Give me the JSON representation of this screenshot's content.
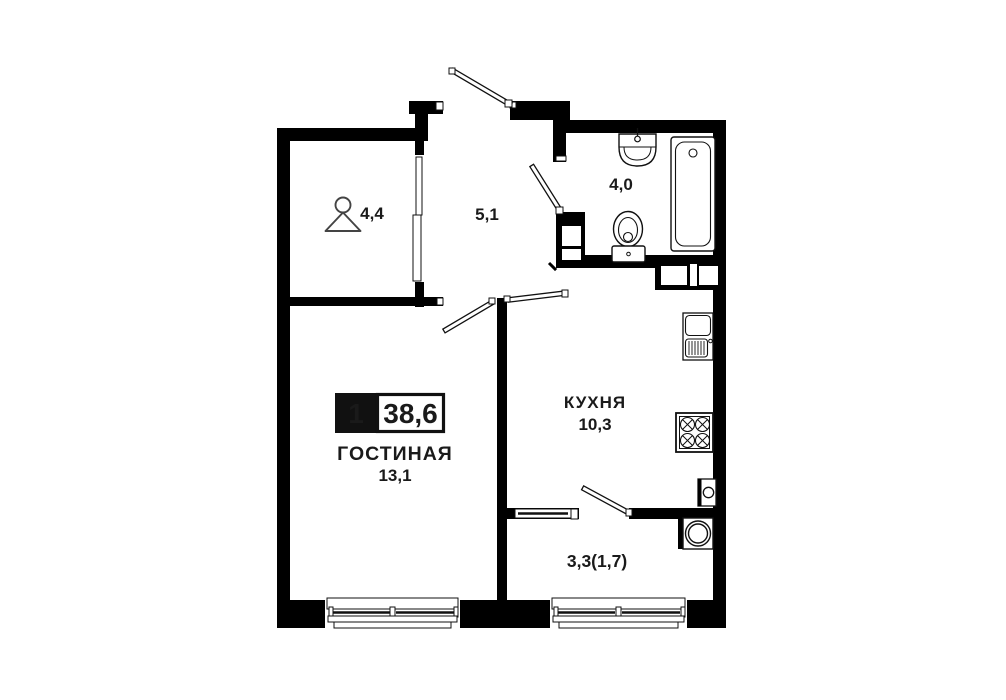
{
  "plan": {
    "badge": {
      "rooms": "1",
      "total_area": "38,6"
    },
    "rooms": {
      "living": {
        "name": "ГОСТИНАЯ",
        "area": "13,1"
      },
      "kitchen": {
        "name": "КУХНЯ",
        "area": "10,3"
      },
      "hallway": {
        "area": "5,1"
      },
      "wardrobe": {
        "area": "4,4"
      },
      "bathroom": {
        "area": "4,0"
      },
      "balcony": {
        "area": "3,3(1,7)"
      }
    },
    "colors": {
      "wall": "#000000",
      "background": "#ffffff",
      "text": "#1a1a1a"
    },
    "icons": [
      "hanger-icon",
      "bathroom-sink-icon",
      "toilet-icon",
      "bathtub-icon",
      "kitchen-sink-icon",
      "stove-icon",
      "water-heater-icon",
      "washing-machine-icon"
    ]
  }
}
